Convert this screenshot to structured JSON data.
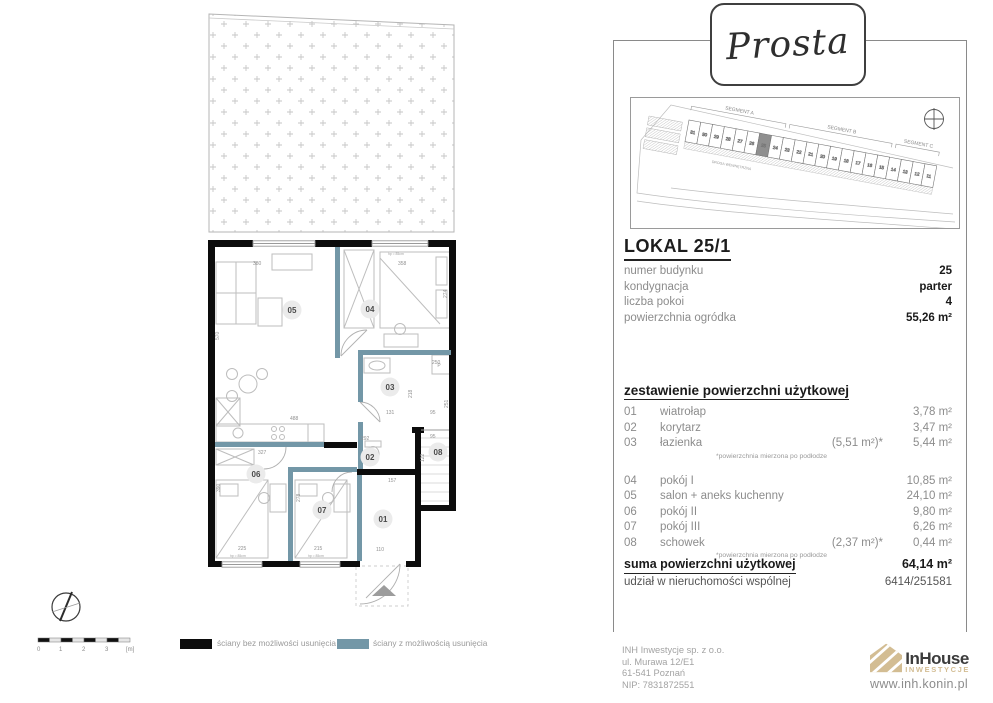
{
  "brand": {
    "name": "Prosta"
  },
  "site_plan": {
    "segment_labels": [
      "SEGMENT A",
      "SEGMENT B",
      "SEGMENT C"
    ],
    "road_label": "DROGA WEWNĘTRZNA",
    "plots": [
      "31",
      "30",
      "29",
      "28",
      "27",
      "26",
      "25",
      "24",
      "23",
      "22",
      "21",
      "20",
      "19",
      "18",
      "17",
      "16",
      "15",
      "14",
      "13",
      "12",
      "11"
    ],
    "highlighted_plot": "25"
  },
  "unit": {
    "title": "LOKAL 25/1",
    "details": [
      {
        "label": "numer budynku",
        "value": "25"
      },
      {
        "label": "kondygnacja",
        "value": "parter"
      },
      {
        "label": "liczba pokoi",
        "value": "4"
      },
      {
        "label": "powierzchnia ogródka",
        "value": "55,26 m²"
      }
    ]
  },
  "areas": {
    "header": "zestawienie powierzchni użytkowej",
    "rows": [
      {
        "no": "01",
        "name": "wiatrołap",
        "note": "",
        "value": "3,78 m²"
      },
      {
        "no": "02",
        "name": "korytarz",
        "note": "",
        "value": "3,47 m²"
      },
      {
        "no": "03",
        "name": "łazienka",
        "note": "(5,51 m²)*",
        "value": "5,44 m²",
        "footnote": "*powierzchnia mierzona po podłodze"
      },
      {
        "no": "04",
        "name": "pokój I",
        "note": "",
        "value": "10,85 m²"
      },
      {
        "no": "05",
        "name": "salon + aneks kuchenny",
        "note": "",
        "value": "24,10 m²"
      },
      {
        "no": "06",
        "name": "pokój II",
        "note": "",
        "value": "9,80 m²"
      },
      {
        "no": "07",
        "name": "pokój III",
        "note": "",
        "value": "6,26 m²"
      },
      {
        "no": "08",
        "name": "schowek",
        "note": "(2,37 m²)*",
        "value": "0,44 m²",
        "footnote": "*powierzchnia mierzona po podłodze"
      }
    ],
    "sum_label": "suma powierzchni użytkowej",
    "sum_value": "64,14 m²",
    "share_label": "udział w nieruchomości wspólnej",
    "share_value": "6414/251581"
  },
  "floor_plan": {
    "rooms": {
      "r01": "01",
      "r02": "02",
      "r03": "03",
      "r04": "04",
      "r05": "05",
      "r06": "06",
      "r07": "07",
      "r08": "08"
    },
    "dims": {
      "d380": "380",
      "d358": "358",
      "d570": "570",
      "d488": "488",
      "d327": "327",
      "d292": "292",
      "d157": "157",
      "d110": "110",
      "d225": "225",
      "d215": "215",
      "d278": "278",
      "d390": "390",
      "d250": "250",
      "d251": "251",
      "d218": "218",
      "d131": "131",
      "d95a": "95",
      "d95b": "95",
      "d122": "122",
      "d274": "274"
    },
    "window_label": "hp ≈ 85cm",
    "washer_label": "P"
  },
  "legend": {
    "solid_label": "ściany bez możliwości usunięcia",
    "removable_label": "ściany z możliwością usunięcia"
  },
  "scale_bar": {
    "ticks": [
      "0",
      "1",
      "2",
      "3",
      "[m]"
    ]
  },
  "company": {
    "lines": [
      "INH Inwestycje sp. z o.o.",
      "ul. Murawa 12/E1",
      "61-541 Poznań",
      "NIP: 7831872551"
    ],
    "logo_name": "InHouse",
    "logo_sub": "INWESTYCJE",
    "website": "www.inh.konin.pl"
  },
  "colors": {
    "solid_wall": "#0c0c0c",
    "removable_wall": "#7397a7",
    "brand_tan": "#d3bd93",
    "highlight_plot": "#8f8f8f"
  }
}
